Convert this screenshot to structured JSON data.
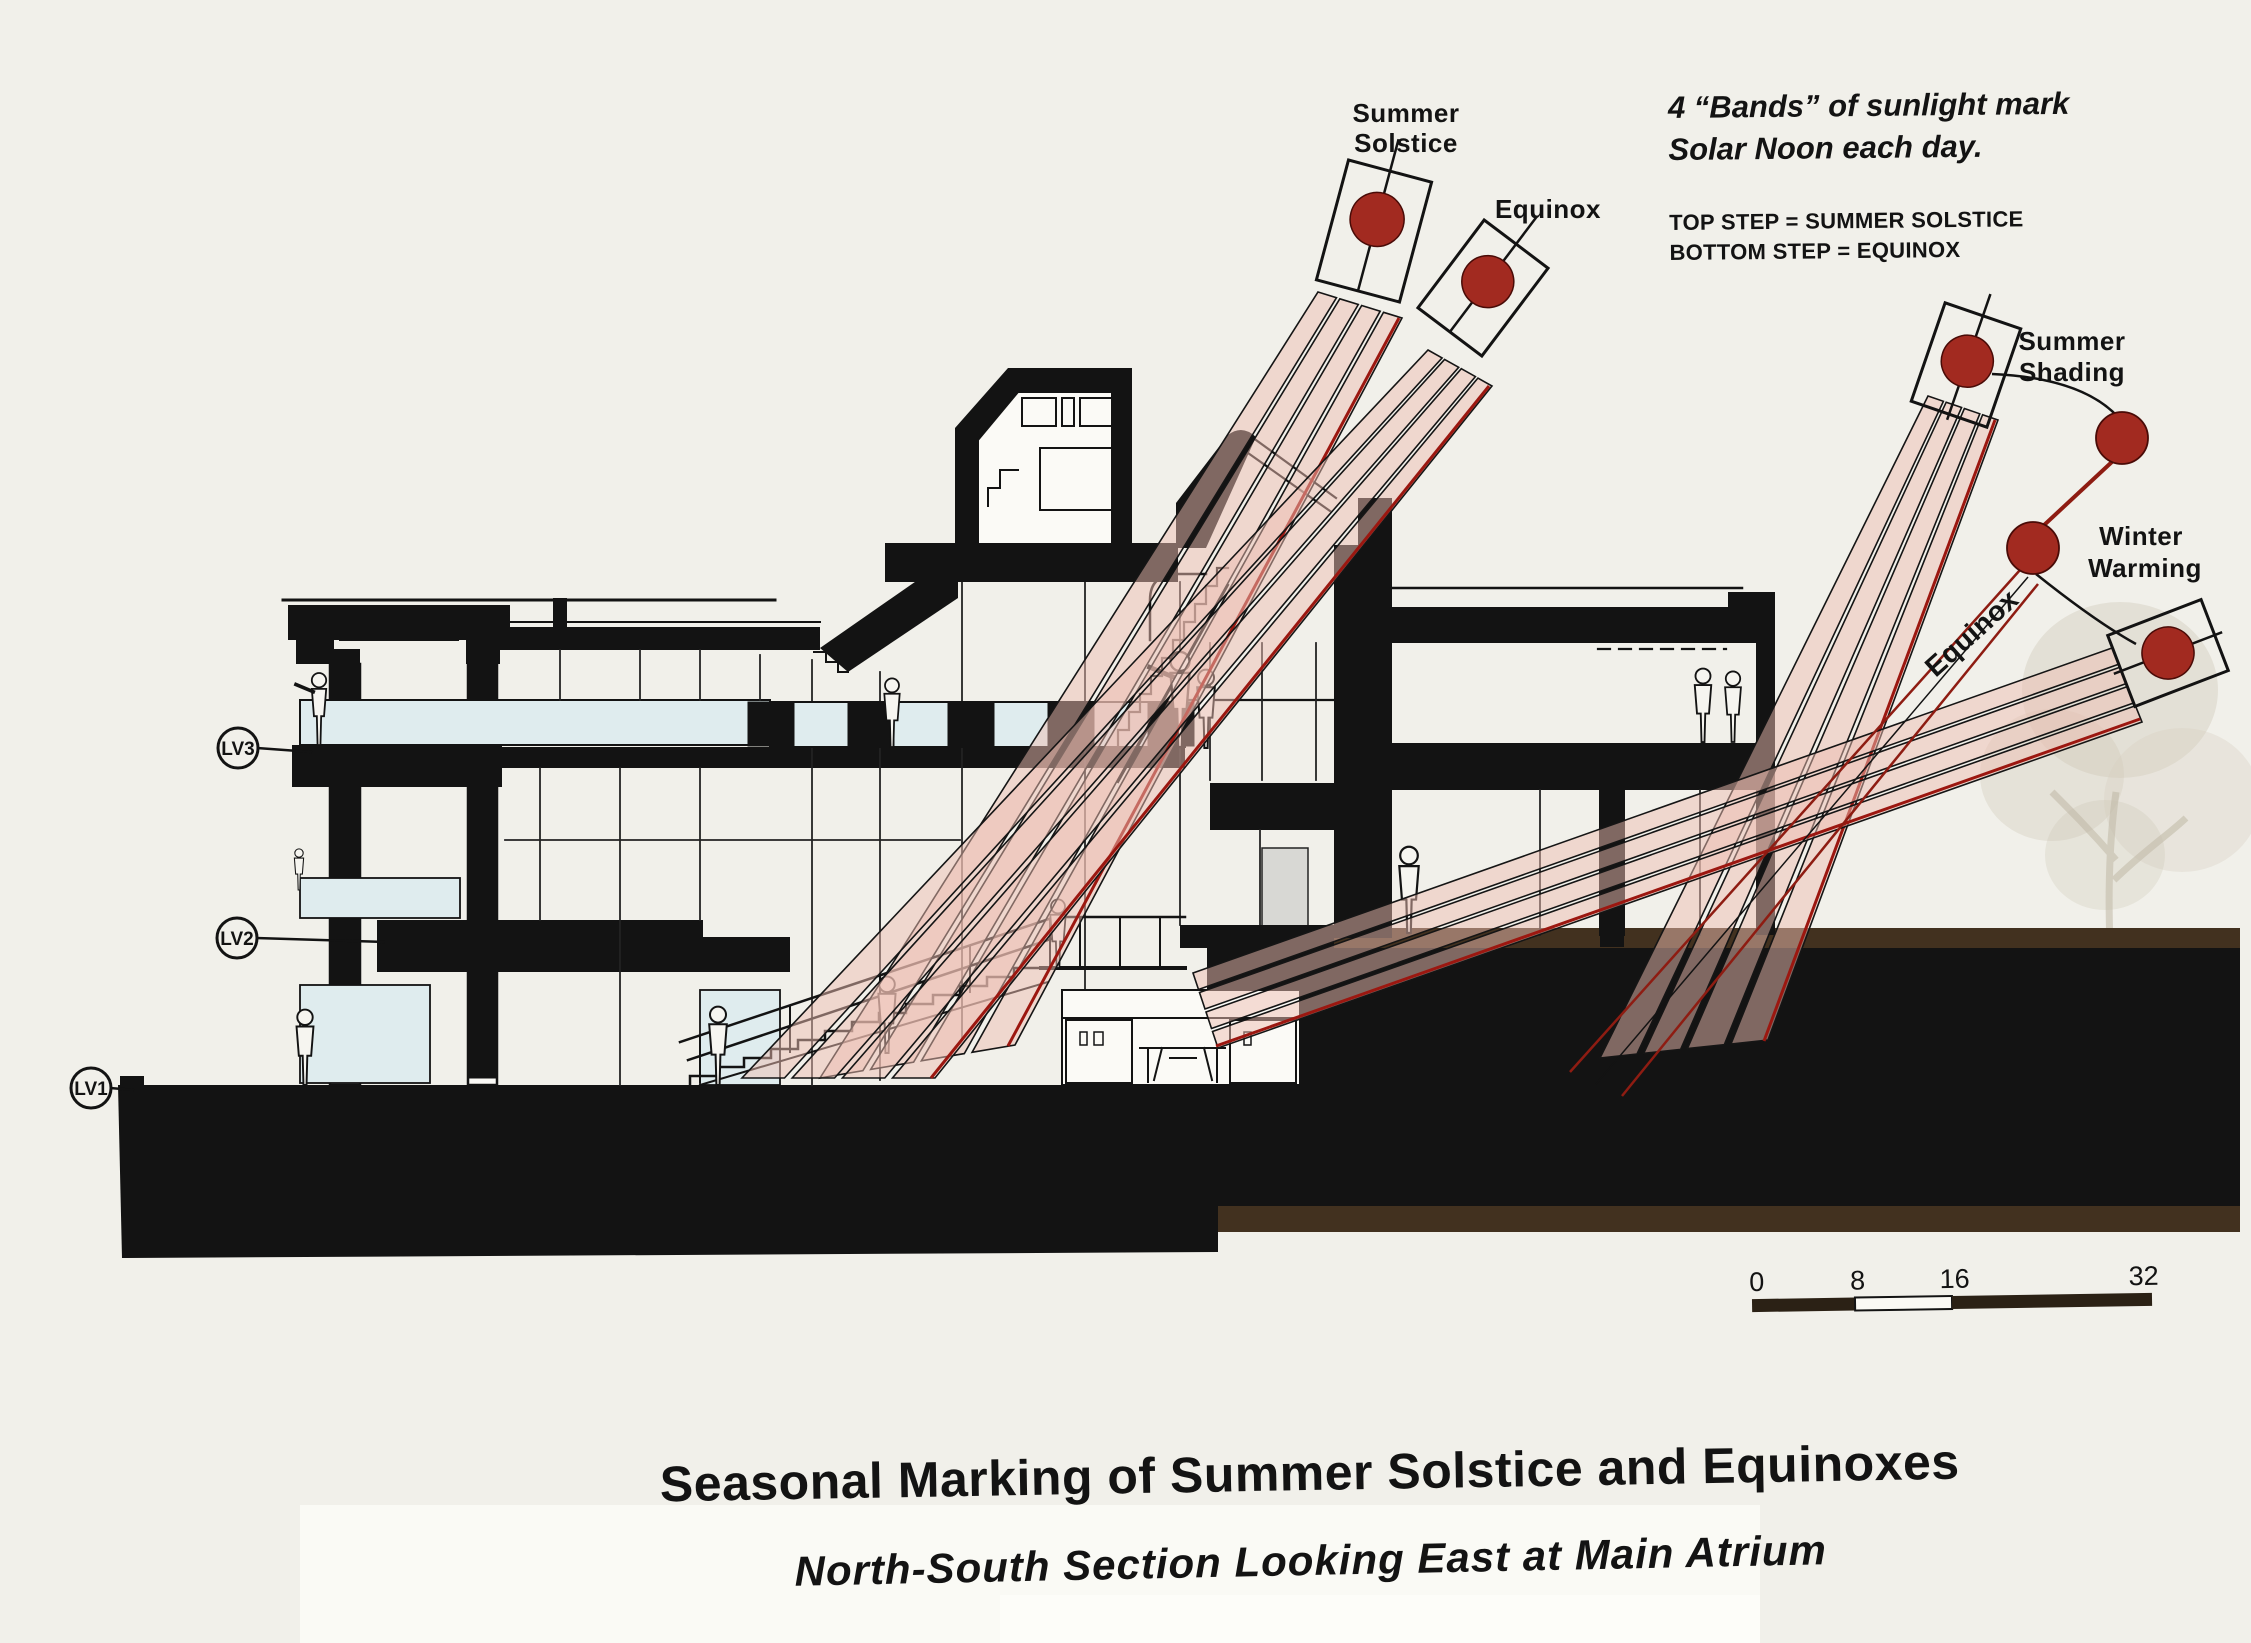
{
  "labels": {
    "summer_solstice": {
      "line1": "Summer",
      "line2": "Solstice"
    },
    "equinox_top": "Equinox",
    "summer_shading": {
      "line1": "Summer",
      "line2": "Shading"
    },
    "winter_warming": {
      "line1": "Winter",
      "line2": "Warming"
    },
    "equinox_rotated": "Equinox"
  },
  "note": {
    "headline_line1": "4 “Bands” of sunlight mark",
    "headline_line2": "Solar Noon each day.",
    "key_line1": "TOP STEP = SUMMER SOLSTICE",
    "key_line2": "BOTTOM STEP = EQUINOX"
  },
  "levels": {
    "lv3": "LV3",
    "lv2": "LV2",
    "lv1": "LV1"
  },
  "scale_bar": {
    "t0": "0",
    "t1": "8",
    "t2": "16",
    "t3": "32"
  },
  "titles": {
    "main": "Seasonal Marking of Summer Solstice and Equinoxes",
    "sub": "North-South Section Looking East at Main Atrium"
  },
  "colors": {
    "paper": "#f1f0ea",
    "ink": "#131313",
    "sun": "#a22a20",
    "band_fill": "#edbdb2",
    "band_red_edge": "#9c1710",
    "glass": "#dfecee",
    "ground_brown": "#42311f"
  }
}
